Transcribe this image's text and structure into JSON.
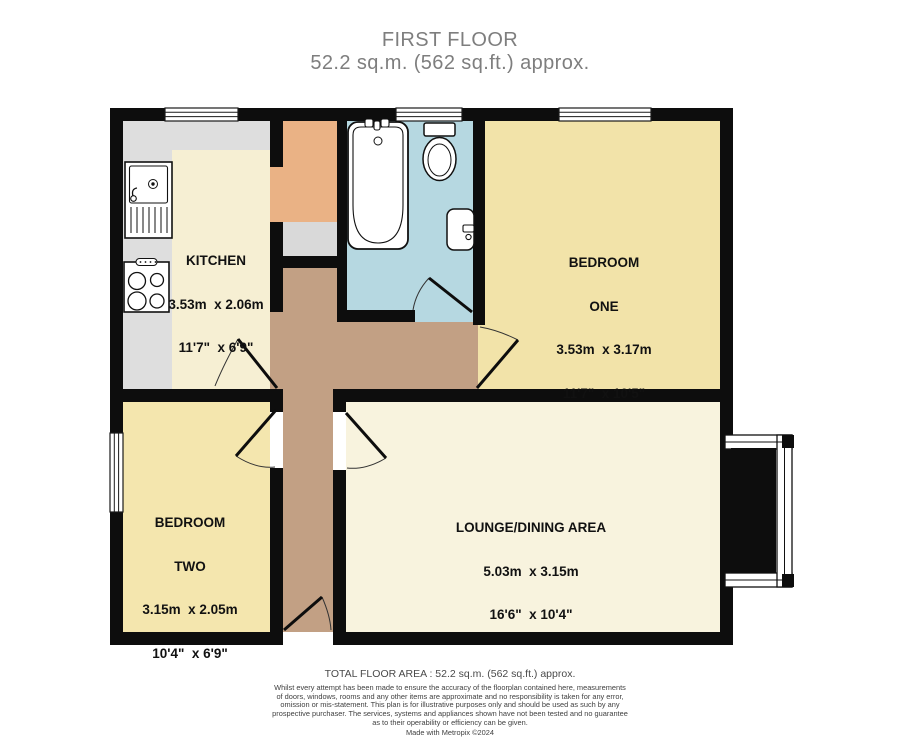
{
  "title": {
    "line1": "FIRST FLOOR",
    "line2": "52.2 sq.m. (562 sq.ft.) approx."
  },
  "rooms": {
    "kitchen": {
      "name": "KITCHEN",
      "metric": "3.53m  x 2.06m",
      "imperial": "11'7\"  x 6'9\""
    },
    "bedroom_one": {
      "name": "BEDROOM",
      "name2": "ONE",
      "metric": "3.53m  x 3.17m",
      "imperial": "11'7\"  x 10'5\""
    },
    "bedroom_two": {
      "name": "BEDROOM",
      "name2": "TWO",
      "metric": "3.15m  x 2.05m",
      "imperial": "10'4\"  x 6'9\""
    },
    "lounge": {
      "name": "LOUNGE/DINING AREA",
      "metric": "5.03m  x 3.15m",
      "imperial": "16'6\"  x 10'4\""
    }
  },
  "footer": {
    "total_area": "TOTAL FLOOR AREA : 52.2 sq.m. (562 sq.ft.) approx.",
    "disclaimer_lines": [
      "Whilst every attempt has been made to ensure the accuracy of the floorplan contained here, measurements",
      "of doors, windows, rooms and any other items are approximate and no responsibility is taken for any error,",
      "omission or mis-statement. This plan is for illustrative purposes only and should be used as such by any",
      "prospective purchaser. The services, systems and appliances shown have not been tested and no guarantee",
      "as to their operability or efficiency can be given."
    ],
    "credit": "Made with Metropix ©2024"
  },
  "colors": {
    "wall": "#0d0d0d",
    "kitchen_floor": "#f6efd3",
    "counter": "#dedede",
    "cupboard": "#eab285",
    "cupboard_shelf": "#d9d9d9",
    "bathroom_floor": "#b6d8e1",
    "bedroom_one_floor": "#f2e3a9",
    "bedroom_two_floor": "#f4e6ae",
    "lounge_floor": "#f8f3de",
    "hallway_floor": "#c2a084",
    "fixture": "#ffffff"
  }
}
